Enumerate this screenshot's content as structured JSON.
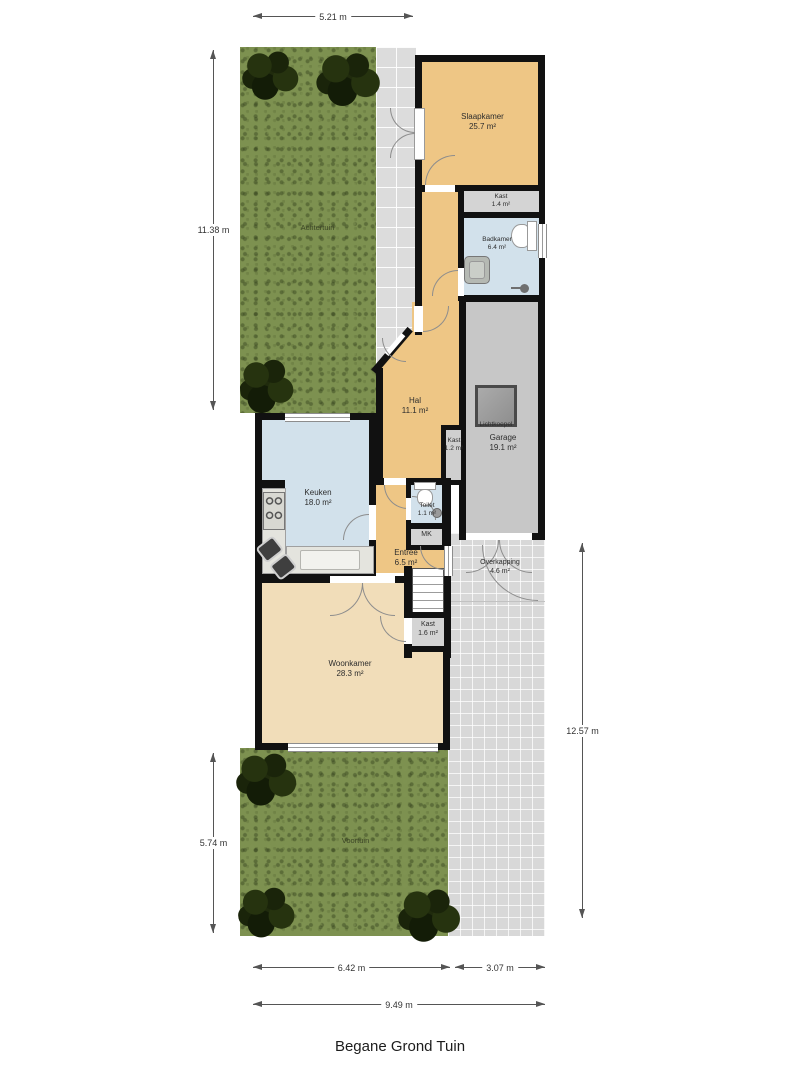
{
  "title": "Begane Grond Tuin",
  "dimensions": {
    "top": "5.21 m",
    "left_upper": "11.38 m",
    "left_lower": "5.74 m",
    "right": "12.57 m",
    "bottom_inner_left": "6.42 m",
    "bottom_inner_right": "3.07 m",
    "bottom_total": "9.49 m"
  },
  "rooms": {
    "slaapkamer": {
      "name": "Slaapkamer",
      "area": "25.7 m²"
    },
    "kast_slaapkamer": {
      "name": "Kast",
      "area": "1.4 m²"
    },
    "badkamer": {
      "name": "Badkamer",
      "area": "6.4 m²"
    },
    "hal": {
      "name": "Hal",
      "area": "11.1 m²"
    },
    "kast_hal": {
      "name": "Kast",
      "area": "1.2 m²"
    },
    "garage": {
      "name": "Garage",
      "area": "19.1 m²"
    },
    "lichtkoepel": {
      "name": "Lichtkoepel"
    },
    "keuken": {
      "name": "Keuken",
      "area": "18.0 m²"
    },
    "toilet": {
      "name": "Toilet",
      "area": "1.1 m²"
    },
    "mk": {
      "name": "MK"
    },
    "entree": {
      "name": "Entree",
      "area": "6.5 m²"
    },
    "overkapping": {
      "name": "Overkapping",
      "area": "4.6 m²"
    },
    "kast_trap": {
      "name": "Kast",
      "area": "1.6 m²"
    },
    "woonkamer": {
      "name": "Woonkamer",
      "area": "28.3 m²"
    }
  },
  "garden": {
    "achtertuin": "Achtertuin",
    "voortuin": "Voortuin"
  },
  "colors": {
    "room_orange": "#eec685",
    "room_blue": "#d2e1eb",
    "room_beige": "#f1ddb9",
    "garage_gray": "#c7c7c7",
    "closet_gray": "#d4d4d4",
    "wall_black": "#111111",
    "grass_green": "#7d9150",
    "tile_gray": "#d8d8d8"
  }
}
